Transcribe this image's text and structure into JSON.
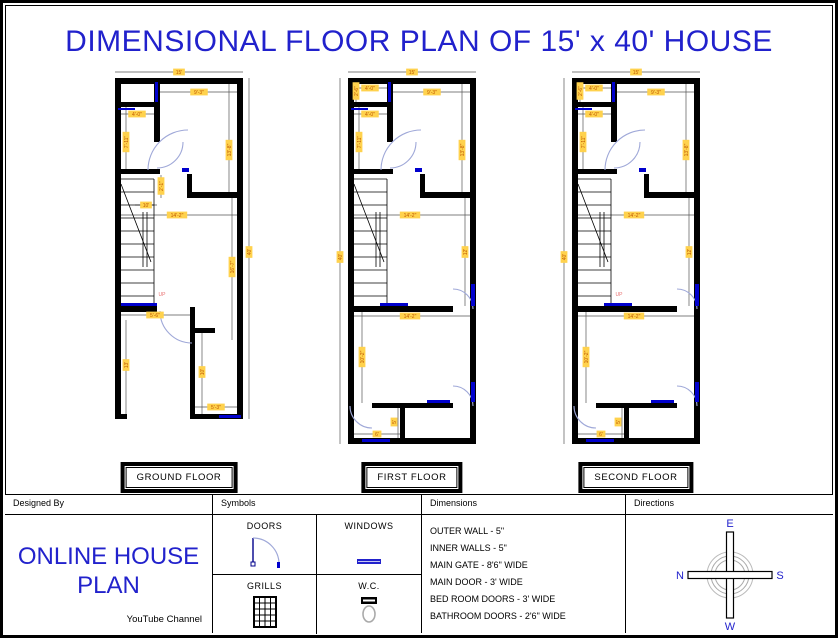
{
  "title": "DIMENSIONAL FLOOR PLAN OF 15' x 40' HOUSE",
  "colors": {
    "title_blue": "#2121cc",
    "brand_blue": "#2222cc",
    "wall_black": "#000000",
    "window_blue": "#0000cd",
    "door_arc": "#9fa8d8",
    "dim_text": "#bf5700",
    "dim_bg": "#ffd24d",
    "up_red": "#e87070"
  },
  "floors": [
    {
      "id": "ground",
      "label": "GROUND FLOOR",
      "labels": [
        {
          "t": "15'",
          "x": 80,
          "y": 10
        },
        {
          "t": "9'-3\"",
          "x": 100,
          "y": 30
        },
        {
          "t": "4'-0\"",
          "x": 38,
          "y": 52
        },
        {
          "t": "7'-11\"",
          "x": 27,
          "y": 80,
          "v": true
        },
        {
          "t": "13'-8\"",
          "x": 130,
          "y": 88,
          "v": true
        },
        {
          "t": "2'-1\"",
          "x": 62,
          "y": 124,
          "v": true
        },
        {
          "t": "10'",
          "x": 47,
          "y": 143
        },
        {
          "t": "14'-2\"",
          "x": 78,
          "y": 153
        },
        {
          "t": "16'-7\"",
          "x": 133,
          "y": 205,
          "v": true
        },
        {
          "t": "40'",
          "x": 150,
          "y": 190,
          "v": true
        },
        {
          "t": "5'-6\"",
          "x": 56,
          "y": 253
        },
        {
          "t": "13'",
          "x": 27,
          "y": 303,
          "v": true
        },
        {
          "t": "10'",
          "x": 103,
          "y": 310,
          "v": true
        },
        {
          "t": "5'-3\"",
          "x": 117,
          "y": 345
        },
        {
          "t": "UP",
          "x": 63,
          "y": 232,
          "up": true
        }
      ]
    },
    {
      "id": "first",
      "label": "FIRST FLOOR",
      "labels": [
        {
          "t": "15'",
          "x": 80,
          "y": 10
        },
        {
          "t": "4'-0\"",
          "x": 38,
          "y": 26
        },
        {
          "t": "2'-6\"",
          "x": 24,
          "y": 29,
          "v": true
        },
        {
          "t": "9'-3\"",
          "x": 100,
          "y": 30
        },
        {
          "t": "4'-0\"",
          "x": 38,
          "y": 52
        },
        {
          "t": "7'-11\"",
          "x": 27,
          "y": 80,
          "v": true
        },
        {
          "t": "13'-8\"",
          "x": 130,
          "y": 88,
          "v": true
        },
        {
          "t": "14'-2\"",
          "x": 78,
          "y": 153
        },
        {
          "t": "12'",
          "x": 133,
          "y": 190,
          "v": true
        },
        {
          "t": "40'",
          "x": 8,
          "y": 195,
          "v": true
        },
        {
          "t": "14'-2\"",
          "x": 78,
          "y": 254
        },
        {
          "t": "10'-2\"",
          "x": 30,
          "y": 295,
          "v": true
        },
        {
          "t": "5'",
          "x": 62,
          "y": 360,
          "v": true
        },
        {
          "t": "6'",
          "x": 45,
          "y": 372
        }
      ]
    },
    {
      "id": "second",
      "label": "SECOND FLOOR",
      "labels": [
        {
          "t": "15'",
          "x": 80,
          "y": 10
        },
        {
          "t": "4'-0\"",
          "x": 38,
          "y": 26
        },
        {
          "t": "2'-6\"",
          "x": 24,
          "y": 29,
          "v": true
        },
        {
          "t": "9'-3\"",
          "x": 100,
          "y": 30
        },
        {
          "t": "4'-0\"",
          "x": 38,
          "y": 52
        },
        {
          "t": "7'-11\"",
          "x": 27,
          "y": 80,
          "v": true
        },
        {
          "t": "13'-8\"",
          "x": 130,
          "y": 88,
          "v": true
        },
        {
          "t": "14'-2\"",
          "x": 78,
          "y": 153
        },
        {
          "t": "12'",
          "x": 133,
          "y": 190,
          "v": true
        },
        {
          "t": "40'",
          "x": 8,
          "y": 195,
          "v": true
        },
        {
          "t": "14'-2\"",
          "x": 78,
          "y": 254
        },
        {
          "t": "10'-2\"",
          "x": 30,
          "y": 295,
          "v": true
        },
        {
          "t": "UP",
          "x": 63,
          "y": 232,
          "up": true
        },
        {
          "t": "5'",
          "x": 62,
          "y": 360,
          "v": true
        },
        {
          "t": "6'",
          "x": 45,
          "y": 372
        }
      ]
    }
  ],
  "footer": {
    "designed_by": {
      "header": "Designed By",
      "line1": "ONLINE HOUSE",
      "line2": "PLAN",
      "subtitle": "YouTube Channel"
    },
    "symbols": {
      "header": "Symbols",
      "doors": "DOORS",
      "windows": "WINDOWS",
      "grills": "GRILLS",
      "wc": "W.C."
    },
    "dimensions": {
      "header": "Dimensions",
      "items": [
        "OUTER WALL - 5\"",
        "INNER WALLS - 5\"",
        "MAIN GATE - 8'6\" WIDE",
        "MAIN DOOR - 3' WIDE",
        "BED ROOM DOORS - 3' WIDE",
        "BATHROOM DOORS - 2'6\" WIDE"
      ]
    },
    "directions": {
      "header": "Directions",
      "east": "E",
      "west": "W",
      "north": "N",
      "south": "S"
    }
  }
}
